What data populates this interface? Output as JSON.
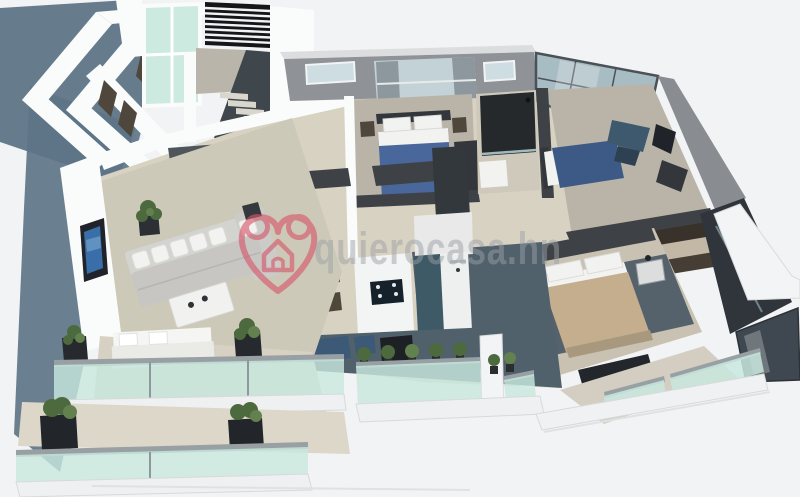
{
  "watermark": {
    "text": "quierocasa.hn",
    "logo_icon": "heart-house-icon",
    "heart_color": "#d6566a",
    "text_color": "#9aa0a6"
  },
  "palette": {
    "background": "#f2f3f5",
    "shadow": "#5e7587",
    "wall_white": "#fafbfb",
    "wall_shade": "#c9cccf",
    "wall_gray": "#8f9296",
    "wall_dark": "#3e4246",
    "floor_beige": "#d8d2c2",
    "floor_living": "#cdc9b9",
    "floor_room": "#bab4a8",
    "floor_dark": "#51616c",
    "floor_slate": "#4e565c",
    "glass": "#c8e8de",
    "glass_frame": "#98a0a4",
    "window_glass": "#cddde2",
    "counter_teal": "#3e5a66",
    "furniture_dark": "#33373c",
    "wood": "#4f463c",
    "bed_blue": "#4a679c",
    "bed_navy": "#3d5a86",
    "bed_tan": "#c5ae8e",
    "sofa_gray": "#c7c6c3",
    "pillow_white": "#f2f2f0",
    "plant_green": "#4c6a3e",
    "plant_light": "#63804f",
    "louver_black": "#141619",
    "curtain_gray": "#8d979e"
  }
}
